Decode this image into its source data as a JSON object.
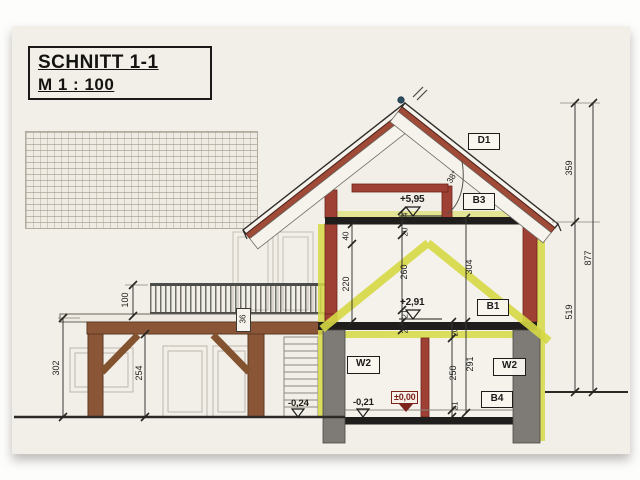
{
  "title_block": {
    "title": "SCHNITT 1-1",
    "scale": "M 1 : 100"
  },
  "component_labels": {
    "roof": "D1",
    "upper_ceiling": "B3",
    "upper_floor": "B1",
    "ground_floor_slab": "B4",
    "wall_left": "W2",
    "wall_right": "W2"
  },
  "level_markers": {
    "upper_ceiling_level": "+5,95",
    "upper_floor_level": "+2,91",
    "ground_floor_level": "±0,00",
    "ground_inside_level": "-0,21",
    "terrain_left_level": "-0,24"
  },
  "angles": {
    "roof_pitch": "38°"
  },
  "dims": {
    "right_ridge_to_eaves": "359",
    "right_eaves_to_ground": "519",
    "right_total": "877",
    "attic_knee": "40",
    "attic_wall": "220",
    "upper_ceiling_pkg": "24",
    "upper_top": "20",
    "upper_room": "260",
    "upper_screed": "21",
    "upper_slab": "20",
    "ground_top": "20",
    "ground_room": "250",
    "ground_screed": "21",
    "storey_upper": "304",
    "storey_ground": "291",
    "carport_height": "302",
    "carport_clear": "254",
    "railing_height": "100",
    "deck_package": "36"
  },
  "colors": {
    "paper": "#f2efe8",
    "highlight_yellow": "#d6d944",
    "timber_red": "#9e4034",
    "wood_brown": "#8a5637",
    "concrete_grey": "#7e7a75",
    "slab_black": "#201e1c",
    "level_red": "#7c241c",
    "ridge_dot_blue": "#2c4f63"
  }
}
